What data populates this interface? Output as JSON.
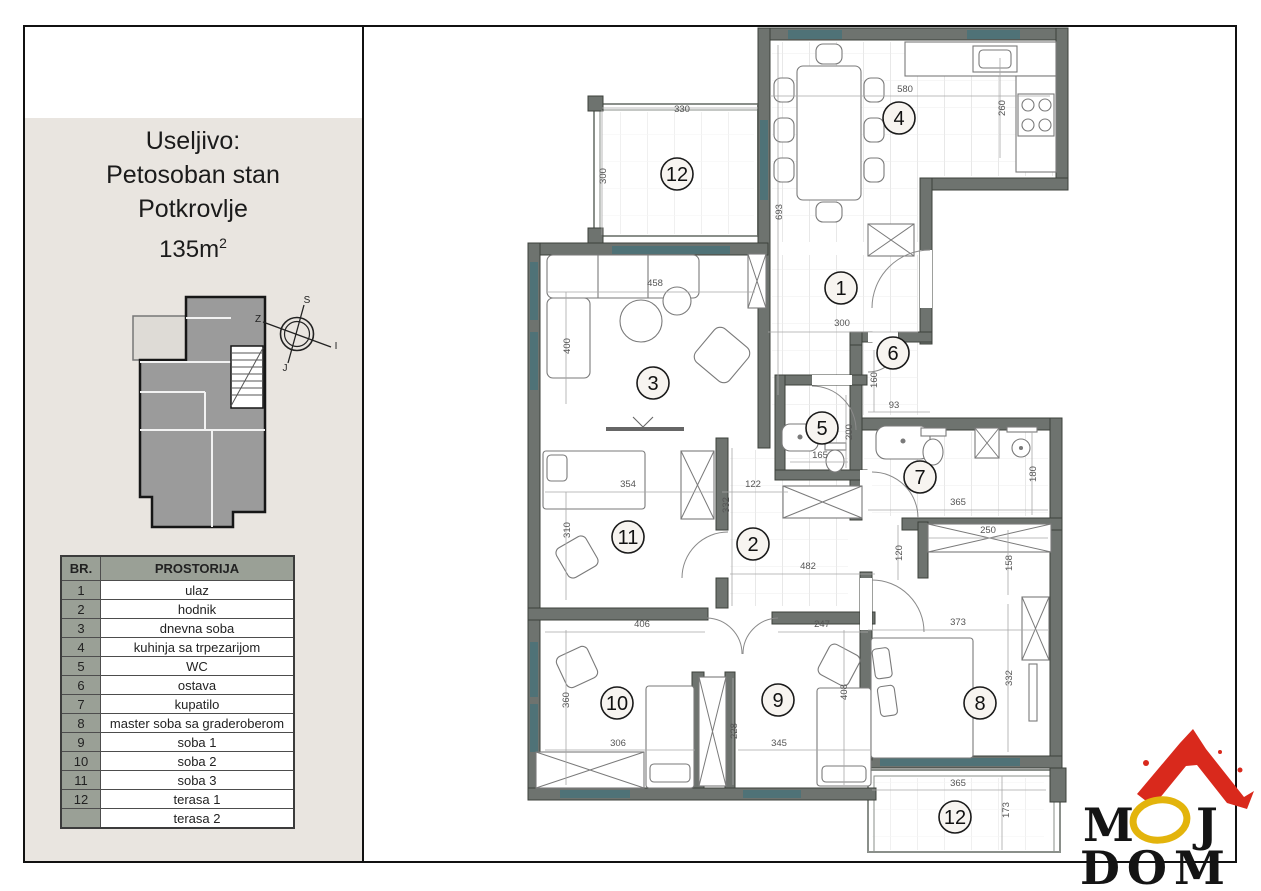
{
  "page": {
    "bg": "#ffffff",
    "frame_color": "#111111"
  },
  "sidebar": {
    "bg": "#e9e5e0",
    "title_lines": [
      "Useljivo:",
      "Petosoban stan",
      "Potkrovlje"
    ],
    "area": {
      "base": "135m",
      "sup": "2"
    },
    "compass": {
      "north": "S",
      "west": "Z",
      "east": "I",
      "south": "J"
    },
    "table": {
      "headers": [
        "BR.",
        "PROSTORIJA"
      ],
      "header_bg": "#9aa096",
      "rows": [
        {
          "num": "1",
          "name": "ulaz"
        },
        {
          "num": "2",
          "name": "hodnik"
        },
        {
          "num": "3",
          "name": "dnevna soba"
        },
        {
          "num": "4",
          "name": "kuhinja sa trpezarijom"
        },
        {
          "num": "5",
          "name": "WC"
        },
        {
          "num": "6",
          "name": "ostava"
        },
        {
          "num": "7",
          "name": "kupatilo"
        },
        {
          "num": "8",
          "name": "master soba sa graderoberom"
        },
        {
          "num": "9",
          "name": "soba 1"
        },
        {
          "num": "10",
          "name": "soba 2"
        },
        {
          "num": "11",
          "name": "soba 3"
        },
        {
          "num": "12",
          "name": "terasa 1"
        },
        {
          "num": "",
          "name": "terasa 2"
        }
      ]
    }
  },
  "plan": {
    "wall_color": "#6e736f",
    "window_color": "#4f7277",
    "room_labels": [
      {
        "num": "12",
        "x": 677,
        "y": 174
      },
      {
        "num": "4",
        "x": 899,
        "y": 118
      },
      {
        "num": "1",
        "x": 841,
        "y": 288
      },
      {
        "num": "6",
        "x": 893,
        "y": 353
      },
      {
        "num": "3",
        "x": 653,
        "y": 383
      },
      {
        "num": "5",
        "x": 822,
        "y": 428
      },
      {
        "num": "7",
        "x": 920,
        "y": 477
      },
      {
        "num": "11",
        "x": 628,
        "y": 537
      },
      {
        "num": "2",
        "x": 753,
        "y": 544
      },
      {
        "num": "10",
        "x": 617,
        "y": 703
      },
      {
        "num": "9",
        "x": 778,
        "y": 700
      },
      {
        "num": "8",
        "x": 980,
        "y": 703
      },
      {
        "num": "12",
        "x": 955,
        "y": 817
      }
    ],
    "dim_labels": [
      {
        "v": "330",
        "x": 682,
        "y": 112,
        "rot": 0
      },
      {
        "v": "300",
        "x": 606,
        "y": 176,
        "rot": -90
      },
      {
        "v": "580",
        "x": 905,
        "y": 92,
        "rot": 0
      },
      {
        "v": "260",
        "x": 1005,
        "y": 108,
        "rot": -90
      },
      {
        "v": "693",
        "x": 782,
        "y": 212,
        "rot": -90
      },
      {
        "v": "300",
        "x": 842,
        "y": 326,
        "rot": 0
      },
      {
        "v": "458",
        "x": 655,
        "y": 286,
        "rot": 0
      },
      {
        "v": "400",
        "x": 570,
        "y": 346,
        "rot": -90
      },
      {
        "v": "160",
        "x": 877,
        "y": 380,
        "rot": -90
      },
      {
        "v": "93",
        "x": 894,
        "y": 408,
        "rot": 0
      },
      {
        "v": "165",
        "x": 820,
        "y": 458,
        "rot": 0
      },
      {
        "v": "200",
        "x": 852,
        "y": 432,
        "rot": -90
      },
      {
        "v": "365",
        "x": 958,
        "y": 505,
        "rot": 0
      },
      {
        "v": "180",
        "x": 1036,
        "y": 474,
        "rot": -90
      },
      {
        "v": "354",
        "x": 628,
        "y": 487,
        "rot": 0
      },
      {
        "v": "310",
        "x": 570,
        "y": 530,
        "rot": -90
      },
      {
        "v": "122",
        "x": 753,
        "y": 487,
        "rot": 0
      },
      {
        "v": "332",
        "x": 729,
        "y": 505,
        "rot": -90
      },
      {
        "v": "482",
        "x": 808,
        "y": 569,
        "rot": 0
      },
      {
        "v": "406",
        "x": 642,
        "y": 627,
        "rot": 0
      },
      {
        "v": "247",
        "x": 822,
        "y": 627,
        "rot": 0
      },
      {
        "v": "250",
        "x": 988,
        "y": 533,
        "rot": 0
      },
      {
        "v": "120",
        "x": 902,
        "y": 553,
        "rot": -90
      },
      {
        "v": "158",
        "x": 1012,
        "y": 563,
        "rot": -90
      },
      {
        "v": "373",
        "x": 958,
        "y": 625,
        "rot": 0
      },
      {
        "v": "332",
        "x": 1012,
        "y": 678,
        "rot": -90
      },
      {
        "v": "360",
        "x": 569,
        "y": 700,
        "rot": -90
      },
      {
        "v": "306",
        "x": 618,
        "y": 746,
        "rot": 0
      },
      {
        "v": "228",
        "x": 737,
        "y": 731,
        "rot": -90
      },
      {
        "v": "345",
        "x": 779,
        "y": 746,
        "rot": 0
      },
      {
        "v": "408",
        "x": 847,
        "y": 692,
        "rot": -90
      },
      {
        "v": "365",
        "x": 958,
        "y": 786,
        "rot": 0
      },
      {
        "v": "173",
        "x": 1009,
        "y": 810,
        "rot": -90
      }
    ]
  },
  "logo": {
    "word1": "MOJ",
    "word2": "DOM",
    "red": "#d9291c",
    "yellow": "#e3b40c",
    "black": "#141414"
  }
}
